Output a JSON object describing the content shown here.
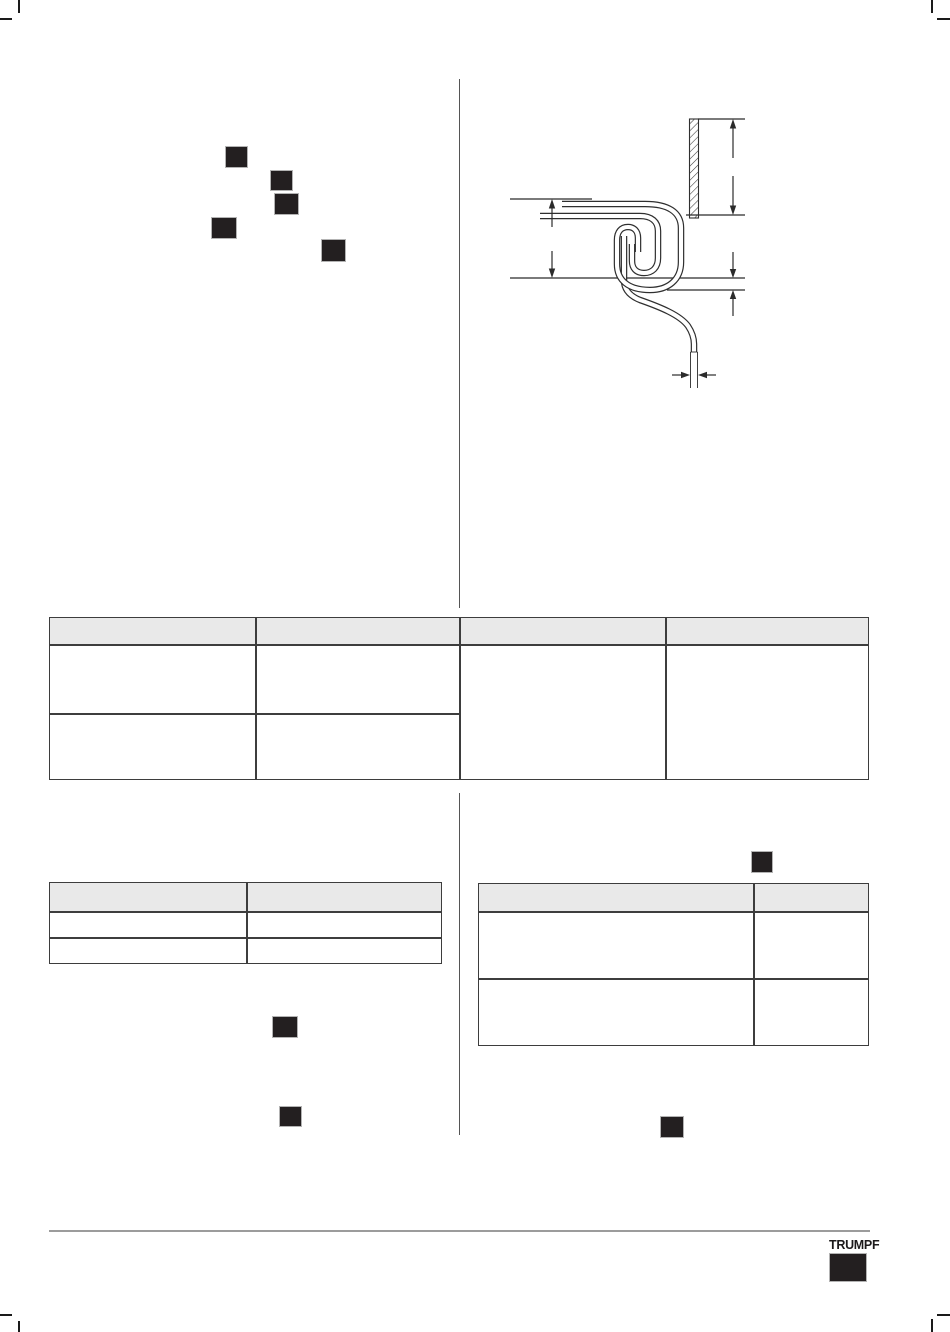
{
  "document": {
    "brand": "TRUMPF",
    "page_kind": "technical manual page with redacted text markers"
  },
  "footer": {
    "logo_text": "TRUMPF"
  },
  "colors": {
    "paper": "#ffffff",
    "redaction_fill": "#231f20",
    "redaction_edge": "#b3b3b3",
    "table_border": "#3d3d3d",
    "table_header_bg": "#e9e9e9",
    "column_divider": "#555555",
    "footer_rule": "#9c9c9c",
    "diagram_stroke": "#2b2b2b",
    "crop_mark": "#1a1a1a"
  },
  "diagram": {
    "name": "sheet-metal-seam-cross-section",
    "features": [
      "hatched-wall-section",
      "upper-sheet",
      "lower-sheet",
      "double-fold-seam",
      "descending-sheet-tail"
    ],
    "dimensions": [
      "wall-height",
      "seam-height",
      "seam-gap",
      "sheet-thickness"
    ],
    "dimension_labels": []
  },
  "tables": {
    "main": {
      "columns": [
        "",
        "",
        "",
        ""
      ],
      "rows": [
        [
          "",
          "",
          "",
          ""
        ],
        [
          "",
          "",
          "",
          ""
        ]
      ],
      "note": "columns 3 and 4 are single merged cells spanning both rows"
    },
    "lower_left": {
      "columns": [
        "",
        ""
      ],
      "rows": [
        [
          "",
          ""
        ],
        [
          "",
          ""
        ]
      ]
    },
    "lower_right": {
      "columns": [
        "",
        ""
      ],
      "rows": [
        [
          "",
          ""
        ],
        [
          "",
          ""
        ]
      ]
    }
  },
  "redactions": {
    "count": 9
  }
}
